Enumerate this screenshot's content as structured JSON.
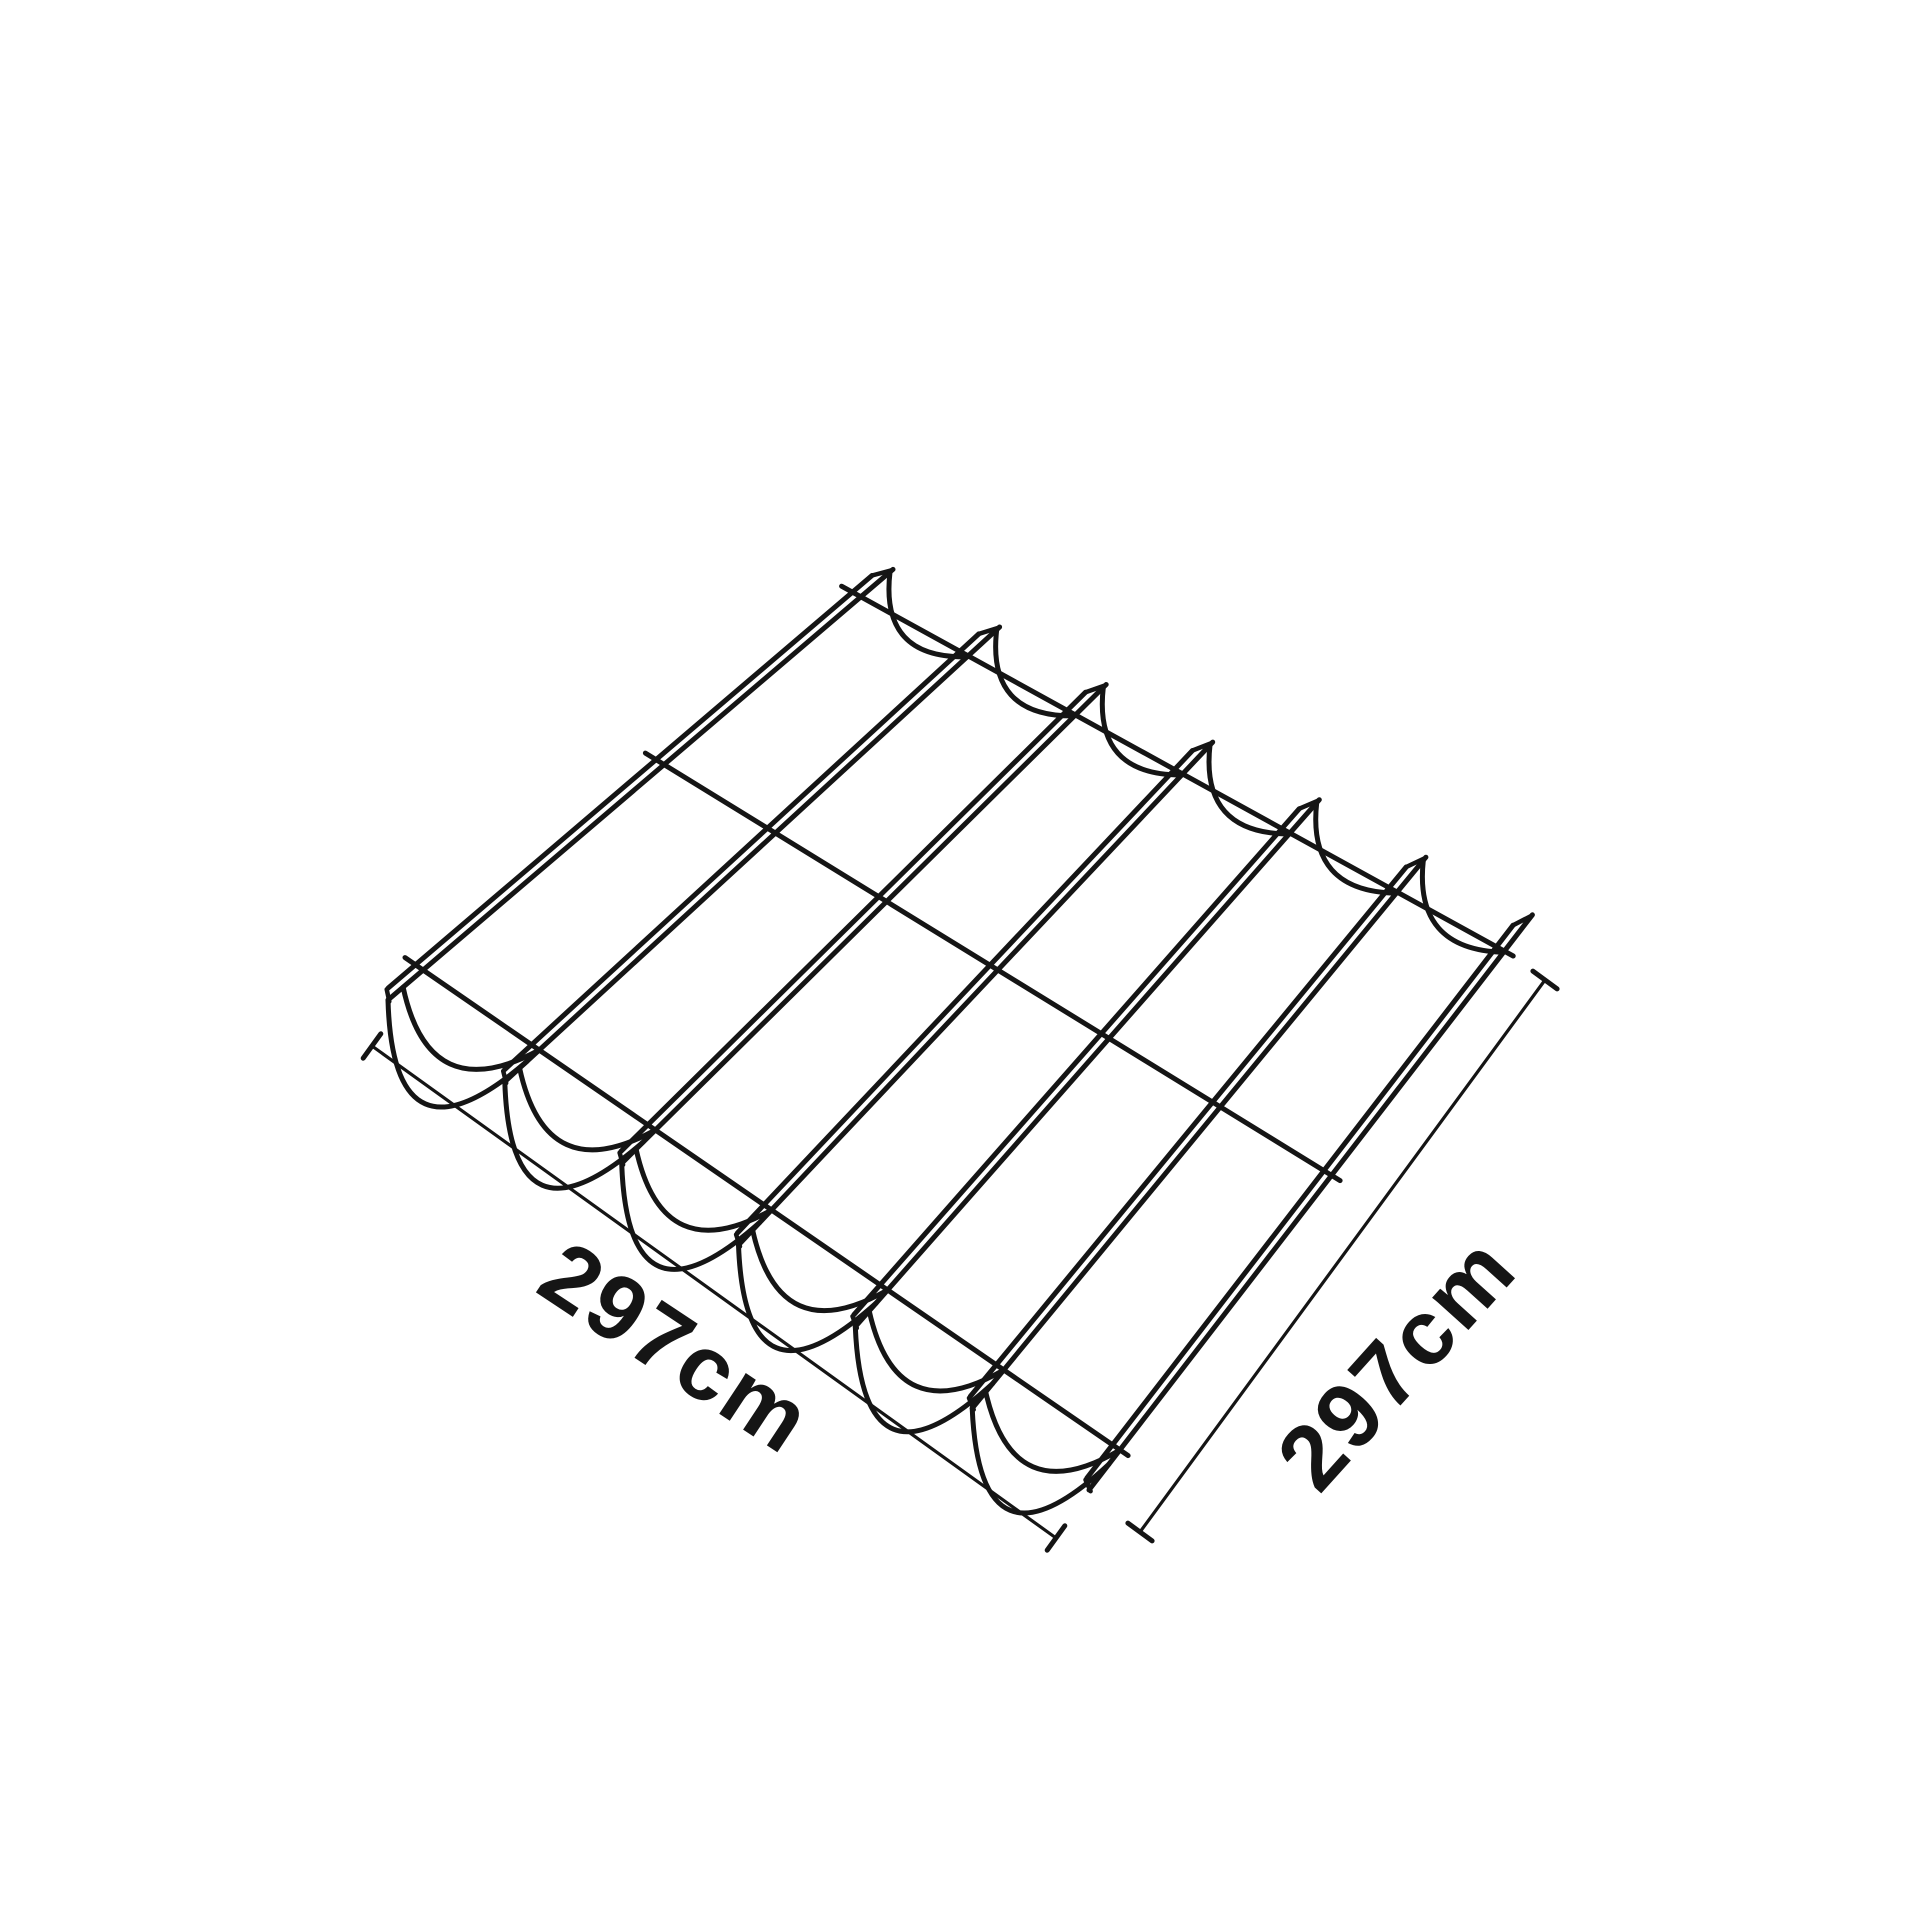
{
  "page": {
    "background_color": "#ffffff"
  },
  "diagram": {
    "description": "isometric line drawing of a square pergola shade canopy with seven parallel support rails, scalloped fabric peaks along the far edge, drooping fabric swags along the near edge and three cross support wires",
    "line_color": "#151515",
    "rail_count": 7,
    "support_wire_count": 3
  },
  "dimensions": {
    "width_label": "297cm",
    "depth_label": "297cm"
  }
}
